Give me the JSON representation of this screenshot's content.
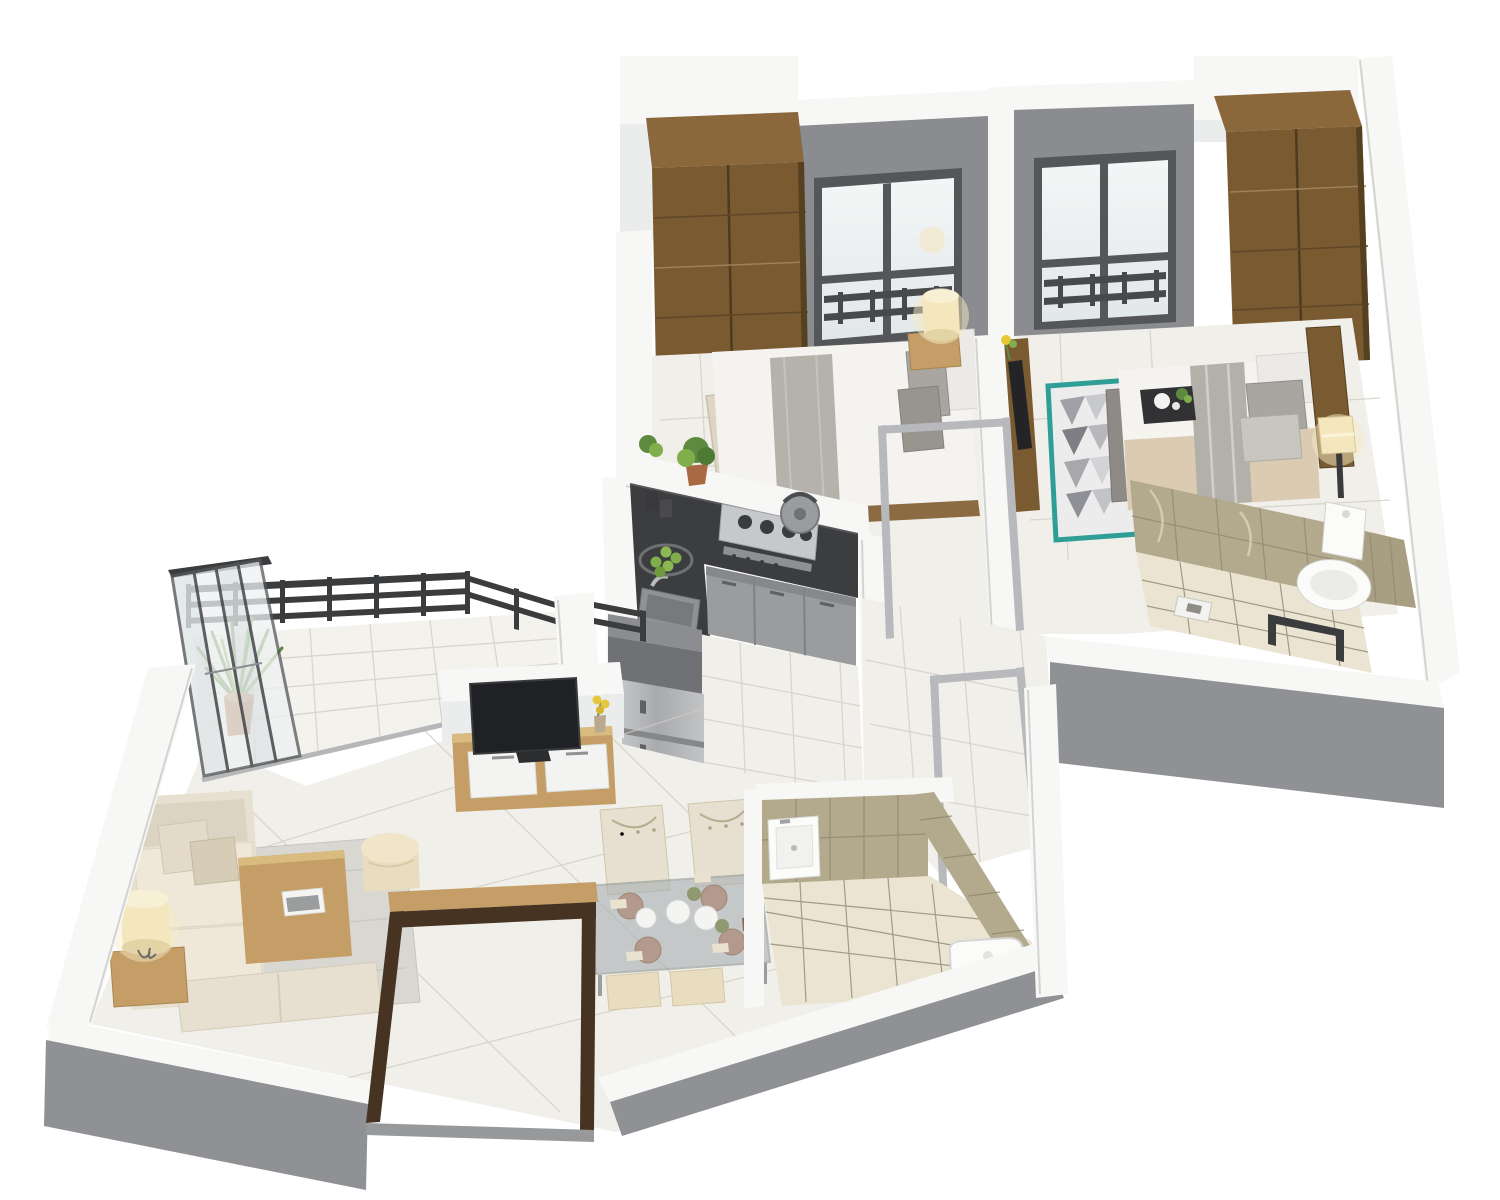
{
  "scene": {
    "type": "3d-isometric-floor-plan-render",
    "rooms": [
      {
        "name": "bedroom-1",
        "items": [
          "wardrobe",
          "window",
          "double-bed",
          "bed-runner",
          "pillows",
          "nightstand",
          "table-lamp",
          "runner-rug"
        ]
      },
      {
        "name": "bedroom-2",
        "items": [
          "wardrobe",
          "window",
          "double-bed",
          "wood-headboard",
          "bed-runner",
          "pillows",
          "breakfast-tray",
          "geometric-rug",
          "bedside-lamp",
          "foot-bench",
          "wall-media-panel"
        ]
      },
      {
        "name": "bathroom-1",
        "items": [
          "marble-tiled-walls",
          "toilet",
          "shower-floor-drain",
          "glass-shower-partition"
        ]
      },
      {
        "name": "kitchen",
        "items": [
          "l-shaped-granite-counter",
          "gas-hob",
          "kettle",
          "sink",
          "base-cabinets",
          "tall-cabinet",
          "refrigerator",
          "potted-herbs",
          "fruit-basket"
        ]
      },
      {
        "name": "hallway",
        "items": [
          "open-metal-door-frames"
        ]
      },
      {
        "name": "living-room",
        "items": [
          "fabric-sofa",
          "throw-pillows",
          "bench-seat",
          "area-rug",
          "coffee-table",
          "books",
          "ottoman-pouf",
          "side-table",
          "table-lamp",
          "tv-unit",
          "television",
          "flower-vase"
        ]
      },
      {
        "name": "balcony",
        "items": [
          "metal-railing",
          "folding-glass-doors",
          "potted-plant"
        ]
      },
      {
        "name": "dining-area",
        "items": [
          "glass-dining-table",
          "place-settings",
          "tufted-chairs",
          "stools"
        ]
      },
      {
        "name": "bathroom-2",
        "items": [
          "marble-tiled-walls",
          "wash-basin",
          "toilet"
        ]
      },
      {
        "name": "entrance",
        "items": [
          "wooden-door-frame"
        ]
      }
    ]
  },
  "colors": {
    "background": "#ffffff",
    "wall_top": "#f7f7f6",
    "wall_top_shade": "#ebecec",
    "wall_face_gray": "#8f9194",
    "accent_wall_gray": "#8a8c8f",
    "floor_tile": "#f1efe9",
    "floor_grout": "#cfccc2",
    "bath_floor": "#ece4d2",
    "marble_tile": "#b3a98c",
    "marble_grout": "#8f8770",
    "window_frame": "#54565a",
    "glass": "#edf0f1",
    "railing_dark": "#3b3c3e",
    "steel": "#b7b9bc",
    "counter_dark": "#3c3d3f",
    "cabinet_gray": "#9a9c9e",
    "wood_mid": "#7a5a31",
    "wood_top": "#8a683c",
    "wood_light": "#c49e66",
    "wood_door": "#463321",
    "sofa_cream": "#e7e0d0",
    "pillow_gray": "#a9a6a1",
    "bed_white": "#f4f3f0",
    "runner_gray": "#b5b2ac",
    "blanket_beige": "#dacbb2",
    "rug_gray": "#d9d7d2",
    "rug_teal": "#2f9e97",
    "lamp_warm": "#f4e7bd",
    "plant_green": "#5d8a3e",
    "plant_light": "#7fae4a",
    "ottoman_cream": "#e9ddc0",
    "terracotta": "#a96a43"
  }
}
